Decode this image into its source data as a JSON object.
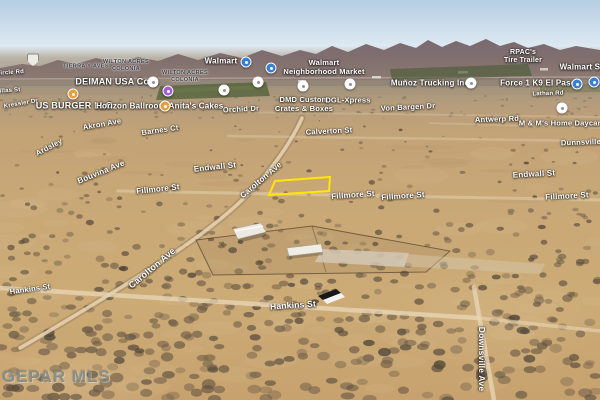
{
  "watermark": "GEPAR MLS",
  "map": {
    "parcel_highlight": {
      "color": "#ffe600",
      "points": [
        [
          275,
          181
        ],
        [
          330,
          177
        ],
        [
          329,
          191
        ],
        [
          269,
          195
        ]
      ]
    },
    "streets": [
      {
        "text": "Circle Rd",
        "x": 10,
        "y": 73,
        "size": 6,
        "rot": -4
      },
      {
        "text": "Villas St",
        "x": 8,
        "y": 91,
        "size": 6,
        "rot": -4
      },
      {
        "text": "Kressler Dr",
        "x": 21,
        "y": 104,
        "size": 6,
        "rot": -10
      },
      {
        "text": "Akron Ave",
        "x": 102,
        "y": 124,
        "size": 7.5,
        "rot": -10
      },
      {
        "text": "Barnes Ct",
        "x": 160,
        "y": 130,
        "size": 7.5,
        "rot": -8
      },
      {
        "text": "Ardsley",
        "x": 49,
        "y": 147,
        "size": 7.5,
        "rot": -28
      },
      {
        "text": "Orchid Dr",
        "x": 241,
        "y": 109,
        "size": 7.5,
        "rot": -3
      },
      {
        "text": "Von Bargen Dr",
        "x": 408,
        "y": 107,
        "size": 7.5,
        "rot": -3
      },
      {
        "text": "Antwerp Rd",
        "x": 497,
        "y": 119,
        "size": 7.5,
        "rot": -2
      },
      {
        "text": "Lathan Rd",
        "x": 548,
        "y": 94,
        "size": 6,
        "rot": -2
      },
      {
        "text": "Calverton St",
        "x": 329,
        "y": 131,
        "size": 7.5,
        "rot": -3
      },
      {
        "text": "Dunnsville St",
        "x": 586,
        "y": 142,
        "size": 7.5,
        "rot": -2
      },
      {
        "text": "Endwall St",
        "x": 215,
        "y": 167,
        "size": 8,
        "rot": -6
      },
      {
        "text": "Endwall St",
        "x": 534,
        "y": 174,
        "size": 8,
        "rot": -3
      },
      {
        "text": "Fillmore St",
        "x": 158,
        "y": 189,
        "size": 8,
        "rot": -6
      },
      {
        "text": "Fillmore St",
        "x": 353,
        "y": 195,
        "size": 8,
        "rot": -4
      },
      {
        "text": "Fillmore St",
        "x": 403,
        "y": 196,
        "size": 8,
        "rot": -4
      },
      {
        "text": "Fillmore St",
        "x": 567,
        "y": 196,
        "size": 8,
        "rot": -3
      },
      {
        "text": "Bouvina Ave",
        "x": 101,
        "y": 172,
        "size": 8,
        "rot": -22
      },
      {
        "text": "Carolton Ave",
        "x": 261,
        "y": 180,
        "size": 8,
        "rot": -40
      },
      {
        "text": "Carolton Ave",
        "x": 152,
        "y": 268,
        "size": 9,
        "rot": -40
      },
      {
        "text": "Hankins St",
        "x": 30,
        "y": 289,
        "size": 7.5,
        "rot": -8
      },
      {
        "text": "Hankins St",
        "x": 293,
        "y": 305,
        "size": 8.5,
        "rot": -4
      },
      {
        "text": "Downsville Ave",
        "x": 482,
        "y": 359,
        "size": 8.5,
        "rot": 90
      }
    ],
    "pois": [
      {
        "lines": [
          "Walmart"
        ],
        "x": 221,
        "y": 61,
        "size": 8
      },
      {
        "lines": [
          "Walmart",
          "Neighborhood Market"
        ],
        "x": 324,
        "y": 68,
        "size": 7.5
      },
      {
        "lines": [
          "DEIMAN USA Corp"
        ],
        "x": 117,
        "y": 82,
        "size": 9
      },
      {
        "lines": [
          "US BURGER LLC"
        ],
        "x": 74,
        "y": 106,
        "size": 9
      },
      {
        "lines": [
          "Horizon Ballroom"
        ],
        "x": 131,
        "y": 106,
        "size": 8
      },
      {
        "lines": [
          "Anita's Cakes"
        ],
        "x": 196,
        "y": 106,
        "size": 8
      },
      {
        "lines": [
          "DMD Custom",
          "Crates & Boxes"
        ],
        "x": 304,
        "y": 105,
        "size": 7.5
      },
      {
        "lines": [
          "DGL-Xpress"
        ],
        "x": 348,
        "y": 101,
        "size": 7.5
      },
      {
        "lines": [
          "Muñoz Trucking Inc"
        ],
        "x": 430,
        "y": 83,
        "size": 8
      },
      {
        "lines": [
          "Force 1 K9 El Paso"
        ],
        "x": 538,
        "y": 83,
        "size": 8
      },
      {
        "lines": [
          "Walmart Sup"
        ],
        "x": 585,
        "y": 67,
        "size": 8
      },
      {
        "lines": [
          "M & M's Home Daycare"
        ],
        "x": 562,
        "y": 124,
        "size": 7.5
      },
      {
        "lines": [
          "RPAC's",
          "Tire Trailer"
        ],
        "x": 523,
        "y": 57,
        "size": 7
      }
    ],
    "colonias": [
      {
        "lines": [
          "TIERRA Y AVES"
        ],
        "x": 86,
        "y": 67
      },
      {
        "lines": [
          "WILTON ACRES",
          "COLONIA"
        ],
        "x": 126,
        "y": 66
      },
      {
        "lines": [
          "WILTON ACRES",
          "COLONIA"
        ],
        "x": 185,
        "y": 77
      }
    ],
    "icons": [
      {
        "name": "highway-shield-icon",
        "style": "shield",
        "x": 33,
        "y": 60
      },
      {
        "name": "walmart-store-icon",
        "style": "tinted",
        "color": "#3a7fd6",
        "x": 246,
        "y": 62
      },
      {
        "name": "walmart-store-icon",
        "style": "tinted",
        "color": "#3a7fd6",
        "x": 271,
        "y": 68
      },
      {
        "name": "shopping-icon",
        "style": "tinted",
        "color": "#a65cd6",
        "x": 168,
        "y": 91
      },
      {
        "name": "restaurant-icon",
        "style": "tinted",
        "color": "#eb9d3e",
        "x": 73,
        "y": 94
      },
      {
        "name": "restaurant-icon",
        "style": "tinted",
        "color": "#eb9d3e",
        "x": 165,
        "y": 106
      },
      {
        "name": "business-icon",
        "style": "light",
        "x": 153,
        "y": 82
      },
      {
        "name": "business-icon",
        "style": "light",
        "x": 224,
        "y": 90
      },
      {
        "name": "business-icon",
        "style": "light",
        "x": 258,
        "y": 82
      },
      {
        "name": "business-icon",
        "style": "light",
        "x": 303,
        "y": 86
      },
      {
        "name": "business-icon",
        "style": "light",
        "x": 350,
        "y": 84
      },
      {
        "name": "business-icon",
        "style": "light",
        "x": 471,
        "y": 83
      },
      {
        "name": "business-icon",
        "style": "light",
        "x": 562,
        "y": 108
      },
      {
        "name": "walmart-store-icon",
        "style": "tinted",
        "color": "#3a7fd6",
        "x": 577,
        "y": 84
      },
      {
        "name": "walmart-store-icon",
        "style": "tinted",
        "color": "#3a7fd6",
        "x": 594,
        "y": 82
      }
    ]
  }
}
